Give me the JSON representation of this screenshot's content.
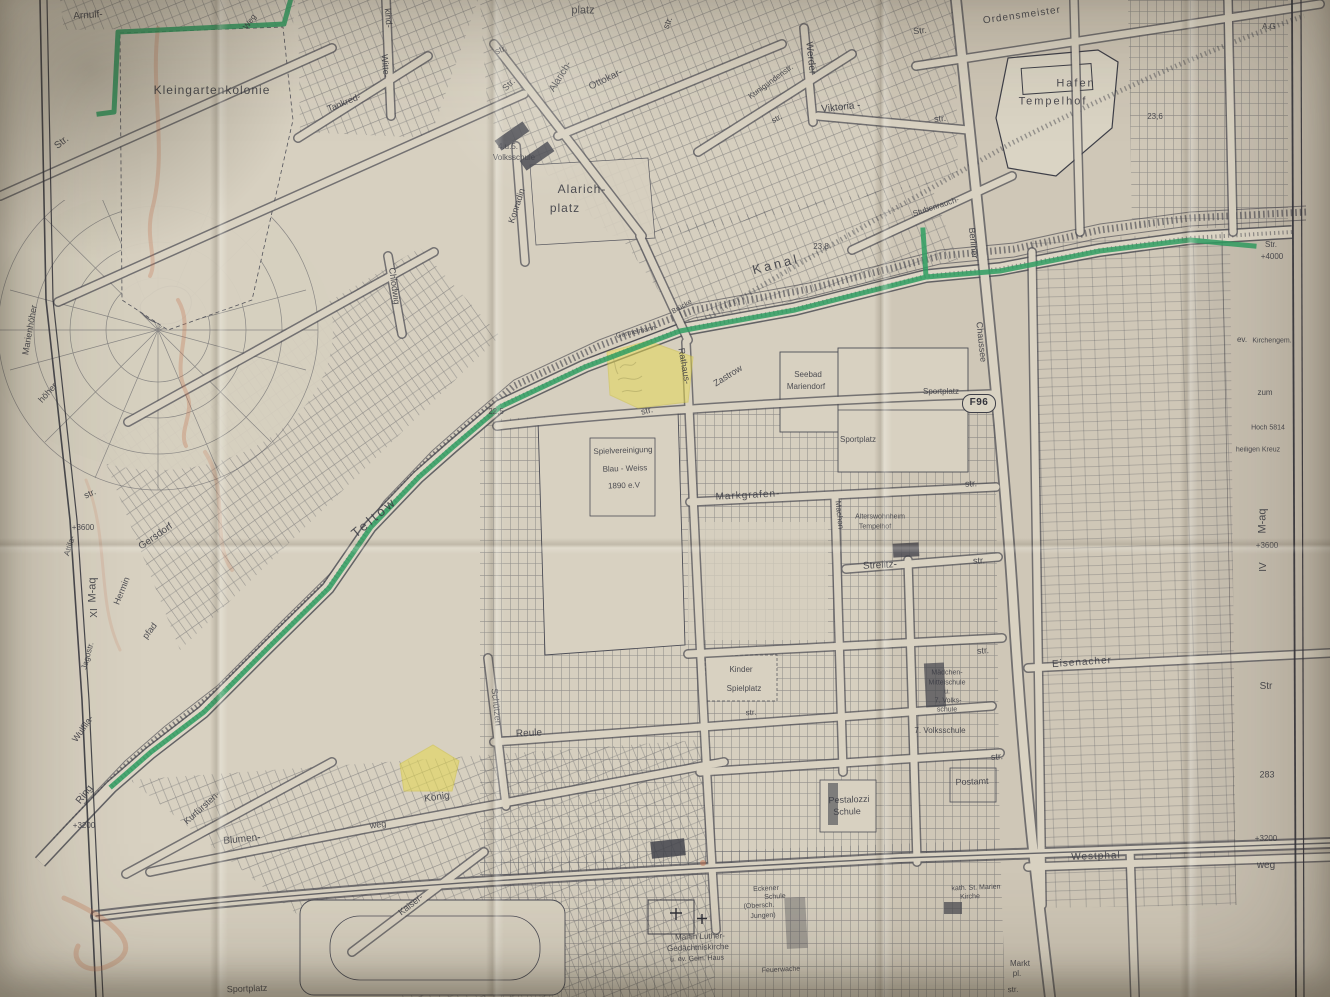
{
  "map": {
    "kind": "historical street map (photographed, folded paper)",
    "route_badge": "F96",
    "colors": {
      "paper": "#d6cfbf",
      "ink": "#3e3f48",
      "highlight_green": "#2f9e62",
      "highlight_yellow": "#e6d94f",
      "crayon_red": "#c4714d"
    },
    "labels": [
      {
        "t": "Arnulf-",
        "x": 88,
        "y": 16,
        "r": -4,
        "s": 10
      },
      {
        "t": "Str.",
        "x": 62,
        "y": 143,
        "r": -38,
        "s": 10
      },
      {
        "t": "Kleingartenkolonie",
        "x": 212,
        "y": 90,
        "r": 0,
        "s": 12,
        "ls": 1
      },
      {
        "t": "Weg",
        "x": 250,
        "y": 22,
        "r": -55,
        "s": 8
      },
      {
        "t": "kind-",
        "x": 388,
        "y": 18,
        "r": 85,
        "s": 9
      },
      {
        "t": "Witte-",
        "x": 385,
        "y": 66,
        "r": 85,
        "s": 9
      },
      {
        "t": "Tankred-",
        "x": 344,
        "y": 103,
        "r": -22,
        "s": 9
      },
      {
        "t": "platz",
        "x": 583,
        "y": 11,
        "r": 0,
        "s": 11
      },
      {
        "t": "str.",
        "x": 501,
        "y": 50,
        "r": -22,
        "s": 9
      },
      {
        "t": "Str.",
        "x": 509,
        "y": 85,
        "r": -45,
        "s": 9
      },
      {
        "t": "Alarich-",
        "x": 561,
        "y": 77,
        "r": -58,
        "s": 10
      },
      {
        "t": "Ottokar-",
        "x": 606,
        "y": 80,
        "r": -26,
        "s": 10
      },
      {
        "t": "str.",
        "x": 668,
        "y": 23,
        "r": -70,
        "s": 9
      },
      {
        "t": "Kunigundenstr.",
        "x": 771,
        "y": 82,
        "r": -36,
        "s": 8
      },
      {
        "t": "Werder",
        "x": 810,
        "y": 58,
        "r": 84,
        "s": 10
      },
      {
        "t": "Viktoria -",
        "x": 841,
        "y": 108,
        "r": -6,
        "s": 10
      },
      {
        "t": "str.",
        "x": 777,
        "y": 119,
        "r": -30,
        "s": 8
      },
      {
        "t": "str.",
        "x": 940,
        "y": 119,
        "r": -5,
        "s": 9
      },
      {
        "t": "4.u.5.",
        "x": 508,
        "y": 147,
        "r": 0,
        "s": 8
      },
      {
        "t": "Volksschule",
        "x": 514,
        "y": 158,
        "r": 0,
        "s": 8
      },
      {
        "t": "Alarich-",
        "x": 582,
        "y": 189,
        "r": 0,
        "s": 12,
        "ls": 1
      },
      {
        "t": "platz",
        "x": 565,
        "y": 208,
        "r": 0,
        "s": 12,
        "ls": 1
      },
      {
        "t": "Konradin",
        "x": 517,
        "y": 206,
        "r": -72,
        "s": 9
      },
      {
        "t": "Chlodwig",
        "x": 394,
        "y": 286,
        "r": 82,
        "s": 9
      },
      {
        "t": "Str.",
        "x": 920,
        "y": 31,
        "r": -6,
        "s": 9
      },
      {
        "t": "Ordensmeister",
        "x": 1022,
        "y": 16,
        "r": -8,
        "s": 10,
        "ls": 1
      },
      {
        "t": "A.G",
        "x": 1269,
        "y": 27,
        "r": 0,
        "s": 8
      },
      {
        "t": "Hafen",
        "x": 1076,
        "y": 84,
        "r": 0,
        "s": 11,
        "ls": 2
      },
      {
        "t": "Tempelhof",
        "x": 1053,
        "y": 102,
        "r": 0,
        "s": 11,
        "ls": 2
      },
      {
        "t": "23,6",
        "x": 1155,
        "y": 117,
        "r": 0,
        "s": 8
      },
      {
        "t": "Stubenrauch-",
        "x": 936,
        "y": 207,
        "r": -18,
        "s": 8
      },
      {
        "t": "Berliner",
        "x": 973,
        "y": 243,
        "r": 84,
        "s": 9
      },
      {
        "t": "Chaussee",
        "x": 981,
        "y": 342,
        "r": 84,
        "s": 9
      },
      {
        "t": "Kanal",
        "x": 776,
        "y": 264,
        "r": -14,
        "s": 13,
        "ls": 3
      },
      {
        "t": "23,8",
        "x": 821,
        "y": 247,
        "r": 0,
        "s": 8
      },
      {
        "t": "Teltow",
        "x": 374,
        "y": 517,
        "r": -40,
        "s": 13,
        "ls": 3
      },
      {
        "t": "Germelmann-",
        "x": 637,
        "y": 332,
        "r": -12,
        "s": 7
      },
      {
        "t": "Brücke",
        "x": 682,
        "y": 307,
        "r": -30,
        "s": 7
      },
      {
        "t": "Rathaus-",
        "x": 684,
        "y": 366,
        "r": 80,
        "s": 9
      },
      {
        "t": "Zastrow",
        "x": 728,
        "y": 376,
        "r": -32,
        "s": 9
      },
      {
        "t": "Seebad",
        "x": 808,
        "y": 375,
        "r": 0,
        "s": 8
      },
      {
        "t": "Mariendorf",
        "x": 806,
        "y": 387,
        "r": 0,
        "s": 8
      },
      {
        "t": "22,5",
        "x": 496,
        "y": 412,
        "r": 0,
        "s": 8
      },
      {
        "t": "str.",
        "x": 647,
        "y": 411,
        "r": -14,
        "s": 9
      },
      {
        "t": "Spielvereinigung",
        "x": 623,
        "y": 451,
        "r": -2,
        "s": 8
      },
      {
        "t": "Blau - Weiss",
        "x": 625,
        "y": 469,
        "r": -2,
        "s": 8
      },
      {
        "t": "1890 e.V",
        "x": 624,
        "y": 486,
        "r": -2,
        "s": 8
      },
      {
        "t": "Markgrafen-",
        "x": 748,
        "y": 496,
        "r": -3,
        "s": 10,
        "ls": 1
      },
      {
        "t": "Machon",
        "x": 839,
        "y": 515,
        "r": 84,
        "s": 8
      },
      {
        "t": "Alterswohnheim",
        "x": 880,
        "y": 517,
        "r": 0,
        "s": 7
      },
      {
        "t": "Tempelhof",
        "x": 875,
        "y": 527,
        "r": 0,
        "s": 7
      },
      {
        "t": "Sportplatz",
        "x": 941,
        "y": 392,
        "r": 0,
        "s": 8
      },
      {
        "t": "Sportplatz",
        "x": 858,
        "y": 440,
        "r": 0,
        "s": 8
      },
      {
        "t": "Strelitz-",
        "x": 880,
        "y": 566,
        "r": -3,
        "s": 10
      },
      {
        "t": "str.",
        "x": 979,
        "y": 561,
        "r": -3,
        "s": 9
      },
      {
        "t": "str.",
        "x": 971,
        "y": 484,
        "r": -3,
        "s": 9
      },
      {
        "t": "Kinder",
        "x": 741,
        "y": 670,
        "r": 0,
        "s": 8
      },
      {
        "t": "Spielplatz",
        "x": 744,
        "y": 689,
        "r": 0,
        "s": 8
      },
      {
        "t": "str.",
        "x": 751,
        "y": 713,
        "r": -3,
        "s": 8
      },
      {
        "t": "Mädchen-",
        "x": 947,
        "y": 673,
        "r": 0,
        "s": 7
      },
      {
        "t": "Mittelschule",
        "x": 947,
        "y": 683,
        "r": 0,
        "s": 7
      },
      {
        "t": "u.",
        "x": 947,
        "y": 692,
        "r": 0,
        "s": 7
      },
      {
        "t": "7. Volks-",
        "x": 948,
        "y": 701,
        "r": 0,
        "s": 7
      },
      {
        "t": "schule",
        "x": 947,
        "y": 710,
        "r": 0,
        "s": 7
      },
      {
        "t": "7. Volksschule",
        "x": 940,
        "y": 731,
        "r": 0,
        "s": 8
      },
      {
        "t": "str.",
        "x": 983,
        "y": 651,
        "r": -4,
        "s": 9
      },
      {
        "t": "str.",
        "x": 997,
        "y": 757,
        "r": -4,
        "s": 9
      },
      {
        "t": "Pestalozzi",
        "x": 849,
        "y": 800,
        "r": -2,
        "s": 9
      },
      {
        "t": "Schule",
        "x": 847,
        "y": 812,
        "r": -2,
        "s": 9
      },
      {
        "t": "Postamt",
        "x": 972,
        "y": 782,
        "r": -2,
        "s": 9
      },
      {
        "t": "Eisenacher",
        "x": 1082,
        "y": 663,
        "r": -4,
        "s": 10,
        "ls": 1
      },
      {
        "t": "Westphal",
        "x": 1096,
        "y": 857,
        "r": -2,
        "s": 10,
        "ls": 1
      },
      {
        "t": "Kurfürsten-",
        "x": 202,
        "y": 808,
        "r": -42,
        "s": 9
      },
      {
        "t": "Blumen-",
        "x": 242,
        "y": 840,
        "r": -6,
        "s": 10
      },
      {
        "t": "weg",
        "x": 378,
        "y": 825,
        "r": -8,
        "s": 9
      },
      {
        "t": "König",
        "x": 437,
        "y": 798,
        "r": -8,
        "s": 10
      },
      {
        "t": "Kaiser-",
        "x": 411,
        "y": 905,
        "r": -38,
        "s": 9
      },
      {
        "t": "Sportplatz",
        "x": 247,
        "y": 989,
        "r": -2,
        "s": 9
      },
      {
        "t": "Schützen",
        "x": 496,
        "y": 707,
        "r": 84,
        "s": 9
      },
      {
        "t": "Reule",
        "x": 529,
        "y": 734,
        "r": -3,
        "s": 10
      },
      {
        "t": "Martin Luther-",
        "x": 700,
        "y": 937,
        "r": -2,
        "s": 8
      },
      {
        "t": "Gedächtniskirche",
        "x": 698,
        "y": 948,
        "r": -2,
        "s": 8
      },
      {
        "t": "u. ev. Gem. Haus",
        "x": 697,
        "y": 959,
        "r": -2,
        "s": 7
      },
      {
        "t": "Eckener",
        "x": 766,
        "y": 889,
        "r": -3,
        "s": 7
      },
      {
        "t": "Schule",
        "x": 775,
        "y": 897,
        "r": -3,
        "s": 7
      },
      {
        "t": "(Obersch.",
        "x": 759,
        "y": 906,
        "r": -3,
        "s": 7
      },
      {
        "t": "Jungen)",
        "x": 763,
        "y": 916,
        "r": -3,
        "s": 7
      },
      {
        "t": "Feuerwache",
        "x": 781,
        "y": 970,
        "r": -3,
        "s": 7
      },
      {
        "t": "kath. St. Marien",
        "x": 976,
        "y": 888,
        "r": -2,
        "s": 7
      },
      {
        "t": "Kirche",
        "x": 970,
        "y": 897,
        "r": -2,
        "s": 7
      },
      {
        "t": "Markt",
        "x": 1020,
        "y": 964,
        "r": 0,
        "s": 8
      },
      {
        "t": "pl.",
        "x": 1017,
        "y": 974,
        "r": 0,
        "s": 8
      },
      {
        "t": "str.",
        "x": 1013,
        "y": 990,
        "r": -3,
        "s": 8
      },
      {
        "t": "Str.",
        "x": 1271,
        "y": 245,
        "r": 0,
        "s": 8
      },
      {
        "t": "+4000",
        "x": 1272,
        "y": 257,
        "r": 0,
        "s": 8
      },
      {
        "t": "ev.",
        "x": 1242,
        "y": 340,
        "r": 0,
        "s": 8
      },
      {
        "t": "Kirchengem.",
        "x": 1272,
        "y": 341,
        "r": 0,
        "s": 7
      },
      {
        "t": "zum",
        "x": 1265,
        "y": 393,
        "r": 0,
        "s": 8
      },
      {
        "t": "Hoch 5814",
        "x": 1268,
        "y": 428,
        "r": 0,
        "s": 7
      },
      {
        "t": "heiligen Kreuz",
        "x": 1258,
        "y": 450,
        "r": 0,
        "s": 7
      },
      {
        "t": "M-aq",
        "x": 1263,
        "y": 521,
        "r": -90,
        "s": 11
      },
      {
        "t": "+3600",
        "x": 1267,
        "y": 546,
        "r": 0,
        "s": 8
      },
      {
        "t": "IV",
        "x": 1264,
        "y": 567,
        "r": -90,
        "s": 10
      },
      {
        "t": "Str",
        "x": 1266,
        "y": 687,
        "r": 0,
        "s": 10
      },
      {
        "t": "283",
        "x": 1267,
        "y": 775,
        "r": 0,
        "s": 9
      },
      {
        "t": "+3200",
        "x": 1266,
        "y": 839,
        "r": 0,
        "s": 8
      },
      {
        "t": "weg",
        "x": 1266,
        "y": 866,
        "r": 0,
        "s": 10
      },
      {
        "t": "Marienhöher",
        "x": 30,
        "y": 330,
        "r": -80,
        "s": 9
      },
      {
        "t": "höher",
        "x": 48,
        "y": 393,
        "r": -48,
        "s": 9
      },
      {
        "t": "str.",
        "x": 90,
        "y": 494,
        "r": -25,
        "s": 9
      },
      {
        "t": "+3600",
        "x": 83,
        "y": 528,
        "r": 0,
        "s": 8
      },
      {
        "t": "Attila-",
        "x": 70,
        "y": 546,
        "r": -72,
        "s": 8
      },
      {
        "t": "Gersdorf",
        "x": 156,
        "y": 537,
        "r": -35,
        "s": 10
      },
      {
        "t": "Hermin",
        "x": 122,
        "y": 591,
        "r": -68,
        "s": 9
      },
      {
        "t": "pfad",
        "x": 150,
        "y": 631,
        "r": -52,
        "s": 9
      },
      {
        "t": "M-aq",
        "x": 93,
        "y": 590,
        "r": -90,
        "s": 11
      },
      {
        "t": "XI",
        "x": 95,
        "y": 613,
        "r": -90,
        "s": 10
      },
      {
        "t": "Jagostr.",
        "x": 88,
        "y": 656,
        "r": -75,
        "s": 8
      },
      {
        "t": "Wulfila-",
        "x": 83,
        "y": 729,
        "r": -55,
        "s": 9
      },
      {
        "t": "Ring",
        "x": 85,
        "y": 795,
        "r": -52,
        "s": 10
      },
      {
        "t": "+3200",
        "x": 84,
        "y": 826,
        "r": 0,
        "s": 8
      }
    ]
  }
}
